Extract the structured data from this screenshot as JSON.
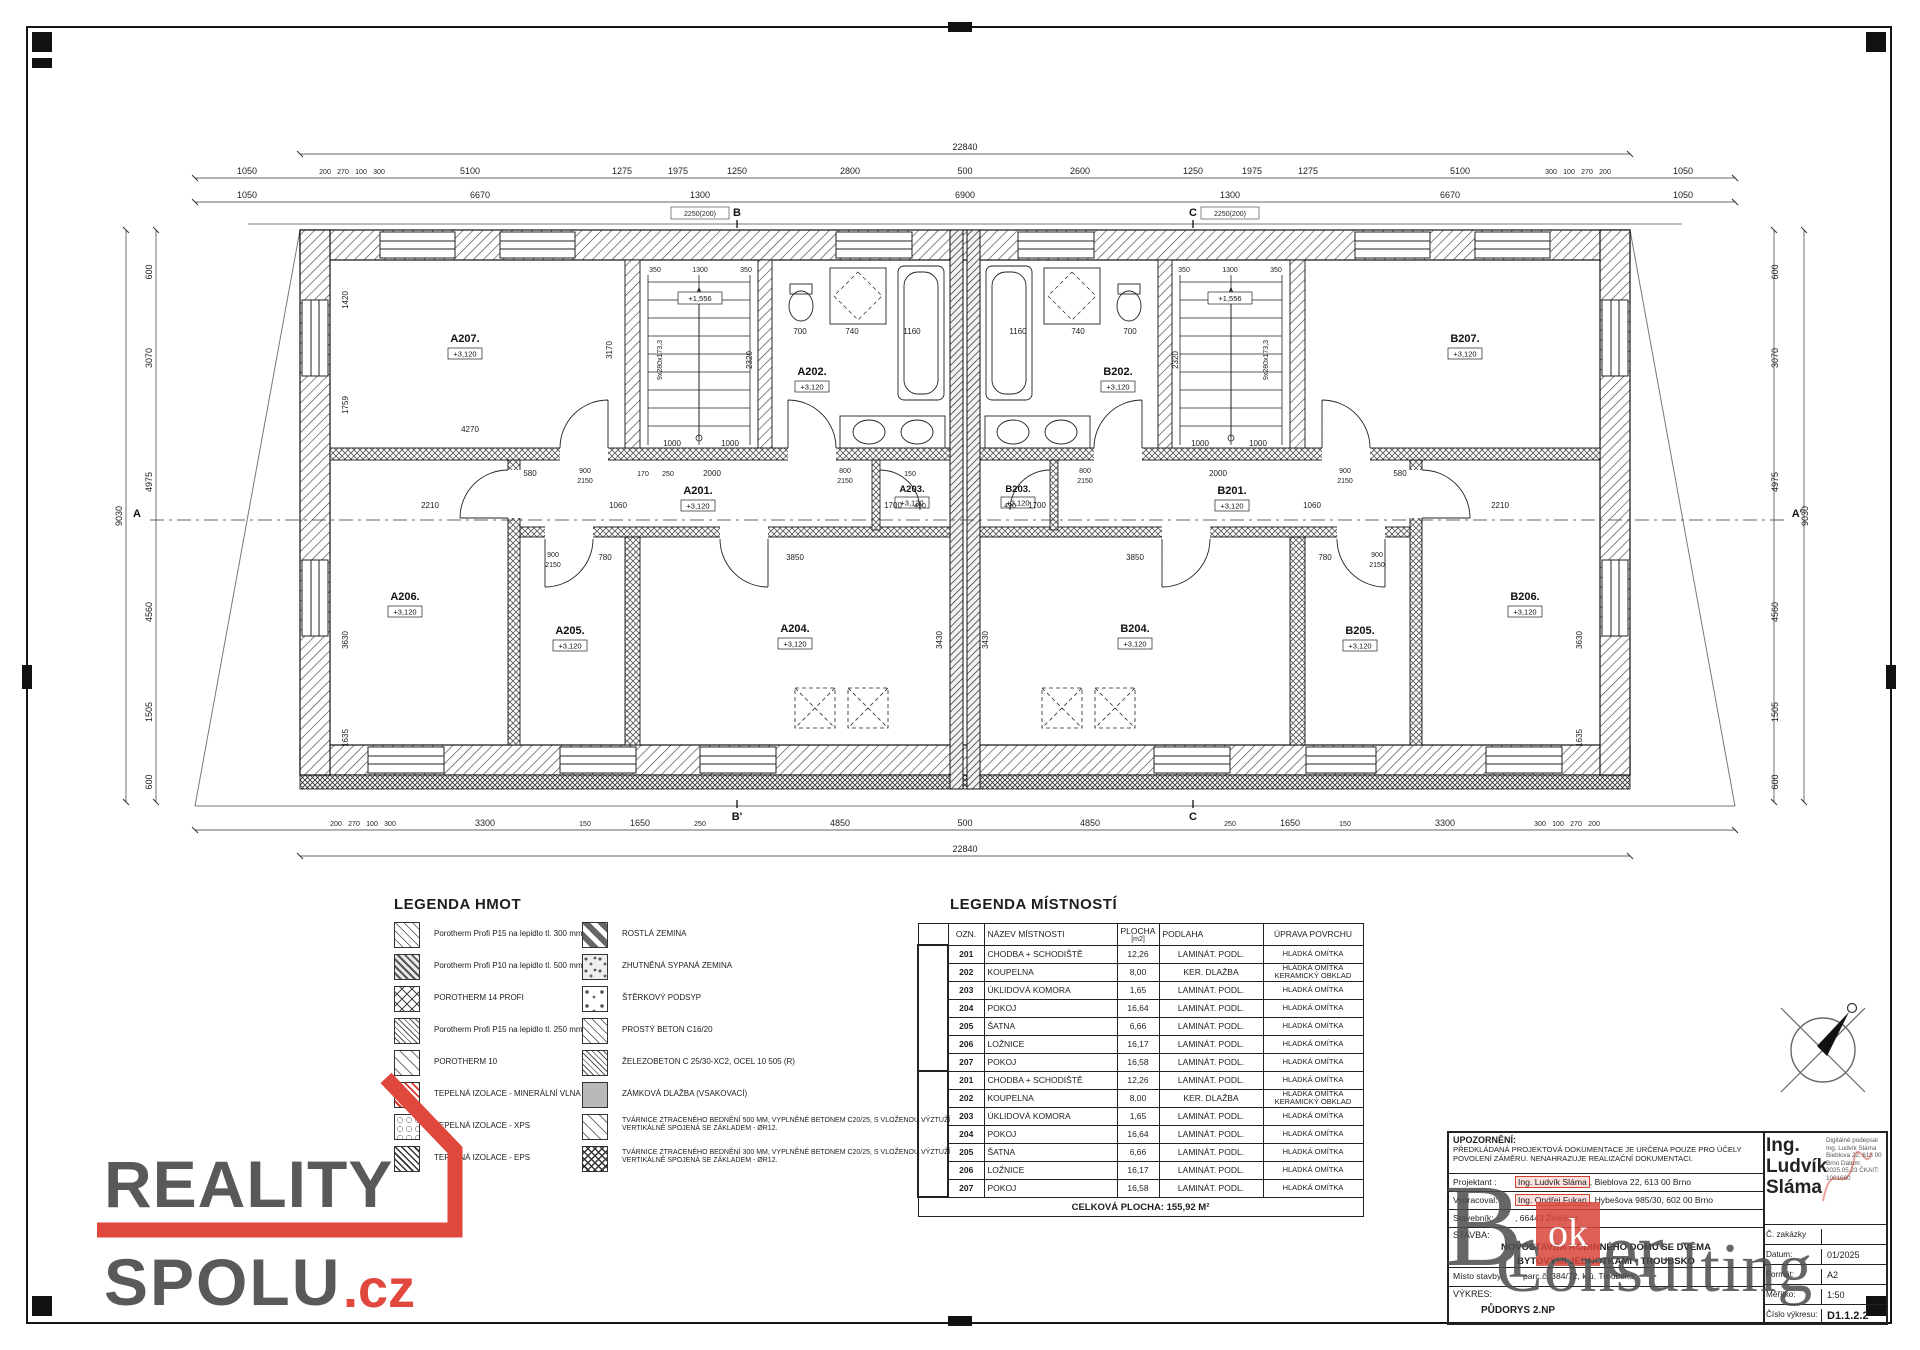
{
  "plan": {
    "rooms": [
      {
        "id": "A207.",
        "elev": "+3,120"
      },
      {
        "id": "A202.",
        "elev": "+3,120"
      },
      {
        "id": "A201.",
        "elev": "+3,120"
      },
      {
        "id": "A203.",
        "elev": "+3,120"
      },
      {
        "id": "A204.",
        "elev": "+3,120"
      },
      {
        "id": "A205.",
        "elev": "+3,120"
      },
      {
        "id": "A206.",
        "elev": "+3,120"
      },
      {
        "id": "B207.",
        "elev": "+3,120"
      },
      {
        "id": "B202.",
        "elev": "+3,120"
      },
      {
        "id": "B201.",
        "elev": "+3,120"
      },
      {
        "id": "B203.",
        "elev": "+3,120"
      },
      {
        "id": "B204.",
        "elev": "+3,120"
      },
      {
        "id": "B205.",
        "elev": "+3,120"
      },
      {
        "id": "B206.",
        "elev": "+3,120"
      }
    ],
    "landing_elev": "+1,556",
    "stair_label": "9x280x173,3",
    "sections": {
      "a": "A",
      "a2": "A'",
      "b": "B",
      "b2": "B'",
      "c": "C"
    },
    "dims": {
      "total_w": "22840",
      "total_h": "9030",
      "d1050": "1050",
      "d200": "200",
      "d270": "270",
      "d100": "100",
      "d300": "300",
      "d5100": "5100",
      "d1275": "1275",
      "d1975": "1975",
      "d1250": "1250",
      "d2800": "2800",
      "d500": "500",
      "d2600": "2600",
      "d6670": "6670",
      "d1300": "1300",
      "d2250": "2250(200)",
      "d6900": "6900",
      "d3300": "3300",
      "d150": "150",
      "d1650": "1650",
      "d250": "250",
      "d4850": "4850",
      "d600": "600",
      "d3070": "3070",
      "d4975": "4975",
      "d4560": "4560",
      "d1505": "1505",
      "d4270": "4270",
      "d3170": "3170",
      "d1420": "1420",
      "d1759": "1759",
      "d580": "580",
      "d900": "900",
      "d2150": "2150",
      "d170": "170",
      "d2000": "2000",
      "d1060": "1060",
      "d800": "800",
      "d490": "490",
      "d2210": "2210",
      "d1700": "1700",
      "d700": "700",
      "d740": "740",
      "d1160": "1160",
      "d350": "350",
      "d1000": "1000",
      "d2320": "2320",
      "d3850": "3850",
      "d3430": "3430",
      "d3630": "3630",
      "d780": "780",
      "d1635": "1635"
    }
  },
  "legend_hmot": {
    "title": "LEGENDA HMOT",
    "left": [
      {
        "label": "Porotherm Profi P15 na lepidlo tl. 300 mm",
        "pattern": "hatch"
      },
      {
        "label": "Porotherm Profi P10 na lepidlo tl. 500 mm",
        "pattern": "hatch-dark"
      },
      {
        "label": "POROTHERM 14 PROFI",
        "pattern": "crosshatch"
      },
      {
        "label": "Porotherm Profi P15 na lepidlo tl. 250 mm",
        "pattern": "hatch-dense"
      },
      {
        "label": "POROTHERM 10",
        "pattern": "dash"
      },
      {
        "label": "TEPELNÁ IZOLACE - MINERÁLNÍ VLNA",
        "pattern": "red-wool"
      },
      {
        "label": "TEPELNÁ IZOLACE - XPS",
        "pattern": "bubbles"
      },
      {
        "label": "TEPELNÁ IZOLACE - EPS",
        "pattern": "diamond"
      }
    ],
    "right": [
      {
        "label": "ROSTLÁ ZEMINA",
        "pattern": "stripes"
      },
      {
        "label": "ZHUTNĚNÁ SYPANÁ ZEMINA",
        "pattern": "speckle"
      },
      {
        "label": "ŠTĚRKOVÝ PODSYP",
        "pattern": "gravel"
      },
      {
        "label": "PROSTÝ BETON C16/20",
        "pattern": "hatch"
      },
      {
        "label": "ŽELEZOBETON C 25/30-XC2, OCEL 10 505 (R)",
        "pattern": "hatch-dense"
      },
      {
        "label": "ZÁMKOVÁ DLAŽBA (VSAKOVACÍ)",
        "pattern": "solid-gray"
      },
      {
        "label": "TVÁRNICE ZTRACENÉHO BEDNĚNÍ 500 MM, VYPLNĚNÉ BETONEM C20/25, S VLOŽENOU VÝZTUŽÍ VERTIKÁLNĚ SPOJENÁ SE ZÁKLADEM - ØR12.",
        "pattern": "dash"
      },
      {
        "label": "TVÁRNICE ZTRACENÉHO BEDNĚNÍ 300 MM, VYPLNĚNÉ BETONEM C20/25, S VLOŽENOU VÝZTUŽÍ VERTIKÁLNĚ SPOJENÁ SE ZÁKLADEM - ØR12.",
        "pattern": "crosshatch-dense"
      }
    ]
  },
  "legend_rooms": {
    "title": "LEGENDA MÍSTNOSTÍ",
    "headers": {
      "ozn": "OZN.",
      "nazev": "NÁZEV MÍSTNOSTI",
      "plocha": "PLOCHA",
      "plocha_unit": "[m2]",
      "podlaha": "PODLAHA",
      "uprava": "ÚPRAVA POVRCHU"
    },
    "rows": [
      {
        "ozn": "201",
        "nazev": "CHODBA + SCHODIŠTĚ",
        "plocha": "12,26",
        "podlaha": "LAMINÁT. PODL.",
        "uprava": "HLADKÁ OMÍTKA",
        "uprava2": ""
      },
      {
        "ozn": "202",
        "nazev": "KOUPELNA",
        "plocha": "8,00",
        "podlaha": "KER. DLAŽBA",
        "uprava": "HLADKÁ OMÍTKA",
        "uprava2": "KERAMICKÝ OBKLAD"
      },
      {
        "ozn": "203",
        "nazev": "ÚKLIDOVÁ KOMORA",
        "plocha": "1,65",
        "podlaha": "LAMINÁT. PODL.",
        "uprava": "HLADKÁ OMÍTKA",
        "uprava2": ""
      },
      {
        "ozn": "204",
        "nazev": "POKOJ",
        "plocha": "16,64",
        "podlaha": "LAMINÁT. PODL.",
        "uprava": "HLADKÁ OMÍTKA",
        "uprava2": ""
      },
      {
        "ozn": "205",
        "nazev": "ŠATNA",
        "plocha": "6,66",
        "podlaha": "LAMINÁT. PODL.",
        "uprava": "HLADKÁ OMÍTKA",
        "uprava2": ""
      },
      {
        "ozn": "206",
        "nazev": "LOŽNICE",
        "plocha": "16,17",
        "podlaha": "LAMINÁT. PODL.",
        "uprava": "HLADKÁ OMÍTKA",
        "uprava2": ""
      },
      {
        "ozn": "207",
        "nazev": "POKOJ",
        "plocha": "16,58",
        "podlaha": "LAMINÁT. PODL.",
        "uprava": "HLADKÁ OMÍTKA",
        "uprava2": ""
      },
      {
        "ozn": "201",
        "nazev": "CHODBA + SCHODIŠTĚ",
        "plocha": "12,26",
        "podlaha": "LAMINÁT. PODL.",
        "uprava": "HLADKÁ OMÍTKA",
        "uprava2": ""
      },
      {
        "ozn": "202",
        "nazev": "KOUPELNA",
        "plocha": "8,00",
        "podlaha": "KER. DLAŽBA",
        "uprava": "HLADKÁ OMÍTKA",
        "uprava2": "KERAMICKÝ OBKLAD"
      },
      {
        "ozn": "203",
        "nazev": "ÚKLIDOVÁ KOMORA",
        "plocha": "1,65",
        "podlaha": "LAMINÁT. PODL.",
        "uprava": "HLADKÁ OMÍTKA",
        "uprava2": ""
      },
      {
        "ozn": "204",
        "nazev": "POKOJ",
        "plocha": "16,64",
        "podlaha": "LAMINÁT. PODL.",
        "uprava": "HLADKÁ OMÍTKA",
        "uprava2": ""
      },
      {
        "ozn": "205",
        "nazev": "ŠATNA",
        "plocha": "6,66",
        "podlaha": "LAMINÁT. PODL.",
        "uprava": "HLADKÁ OMÍTKA",
        "uprava2": ""
      },
      {
        "ozn": "206",
        "nazev": "LOŽNICE",
        "plocha": "16,17",
        "podlaha": "LAMINÁT. PODL.",
        "uprava": "HLADKÁ OMÍTKA",
        "uprava2": ""
      },
      {
        "ozn": "207",
        "nazev": "POKOJ",
        "plocha": "16,58",
        "podlaha": "LAMINÁT. PODL.",
        "uprava": "HLADKÁ OMÍTKA",
        "uprava2": ""
      }
    ],
    "total": "CELKOVÁ PLOCHA: 155,92 M²"
  },
  "title_block": {
    "upozorneni_title": "UPOZORNĚNÍ:",
    "upozorneni_line1": "PŘEDKLÁDANÁ PROJEKTOVÁ DOKUMENTACE JE URČENA POUZE PRO ÚČELY",
    "upozorneni_line2": "POVOLENÍ ZÁMĚRU. NENAHRAZUJE REALIZAČNÍ DOKUMENTACI.",
    "projektant_label": "Projektant :",
    "projektant_name": "Ing. Ludvík Sláma",
    "projektant_rest": ", Bieblova 22, 613 00 Brno",
    "vypracoval_label": "Vypracoval:",
    "vypracoval_name": "Ing. Ondřej Fukan",
    "vypracoval_rest": ", Hybešova 985/30, 602 00 Brno",
    "stavebnik_label": "Stavebník:",
    "stavebnik_value": ", 66443 Želešice",
    "stavba_label": "STAVBA:",
    "stavba_line1": "NOVOSTAVBA RODINNÉHO DOMU SE DVĚMA",
    "stavba_line2": "BYTOVÝMI JEDNOTKAMI - TROUBSKO",
    "misto_label": "Místo stavby:",
    "misto_value": "parc.č. 384/72, k.ú. Troubsko",
    "vykres_label": "VÝKRES:",
    "vykres_value": "PŮDORYS 2.NP",
    "sig_name": "Ing. Ludvík Sláma",
    "sig_lines": "Digitálně podepsal Ing. Ludvík Sláma  Bieblova 22, 613 00 Brno  Datum: 2025.05.23  ČKAIT: 1001660",
    "rows": [
      {
        "label": "Č. zakázky",
        "value": ""
      },
      {
        "label": "Datum:",
        "value": "01/2025"
      },
      {
        "label": "Formát:",
        "value": "A2"
      },
      {
        "label": "Měřítko:",
        "value": "1:50"
      },
      {
        "label": "Číslo výkresu:",
        "value": "D1.1.2.2"
      }
    ]
  },
  "logos": {
    "reality": {
      "word1": "REALITY",
      "word2": "SPOLU",
      "tld": ".cz"
    },
    "broker": {
      "b": "B",
      "r": "r",
      "ok": "ok",
      "er": "er",
      "word2": "Consulting"
    }
  },
  "colors": {
    "accent_red": "#e0473d",
    "logo_gray": "#58595b",
    "watermark_gray": "#4c4c4c",
    "wool_red": "#d8382b"
  }
}
